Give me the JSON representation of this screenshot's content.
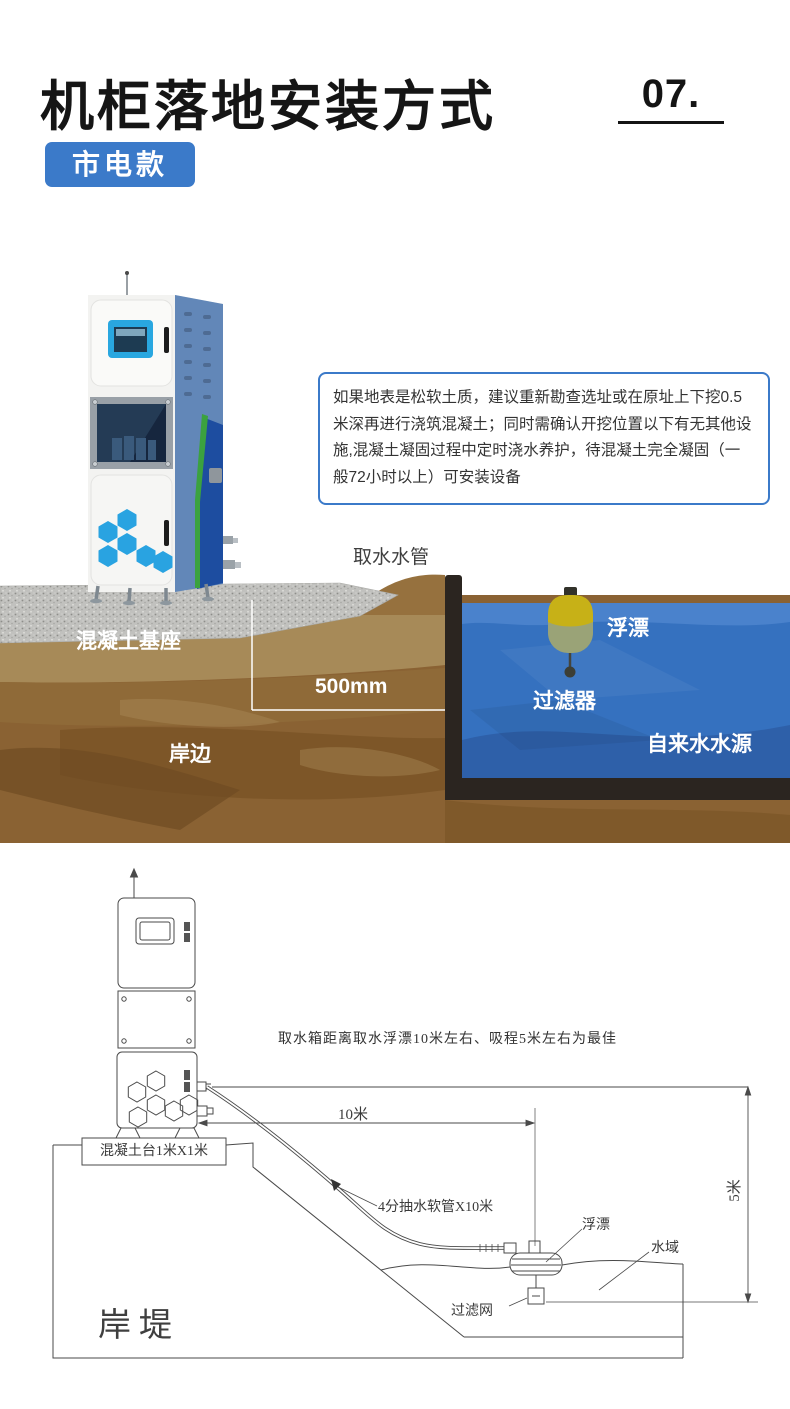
{
  "header": {
    "title": "机柜落地安装方式",
    "page_number": "07.",
    "variant_badge": "市电款",
    "accent_color": "#3b7ac9"
  },
  "note_box": {
    "text": "如果地表是松软土质，建议重新勘查选址或在原址上下挖0.5米深再进行浇筑混凝土；同时需确认开挖位置以下有无其他设施,混凝土凝固过程中定时浇水养护，待混凝土完全凝固（一般72小时以上）可安装设备"
  },
  "scene": {
    "labels": {
      "intake_pipe": "取水水管",
      "concrete_base": "混凝土基座",
      "float": "浮漂",
      "depth_dimension": "500mm",
      "filter": "过滤器",
      "shore": "岸边",
      "water_source": "自来水水源"
    },
    "colors": {
      "water": "#3571bf",
      "soil": "#8a6233",
      "tank_border": "#2b2520",
      "float_top": "#c7b117",
      "cabinet_side": "#6287b8",
      "hexagon": "#29a3e1"
    }
  },
  "diagram": {
    "note": "取水箱距离取水浮漂10米左右、吸程5米左右为最佳",
    "labels": {
      "distance_10m": "10米",
      "height_5m": "5米",
      "platform": "混凝土台1米X1米",
      "hose": "4分抽水软管X10米",
      "float": "浮漂",
      "water_area": "水域",
      "filter_mesh": "过滤网",
      "embankment": "岸堤"
    }
  }
}
